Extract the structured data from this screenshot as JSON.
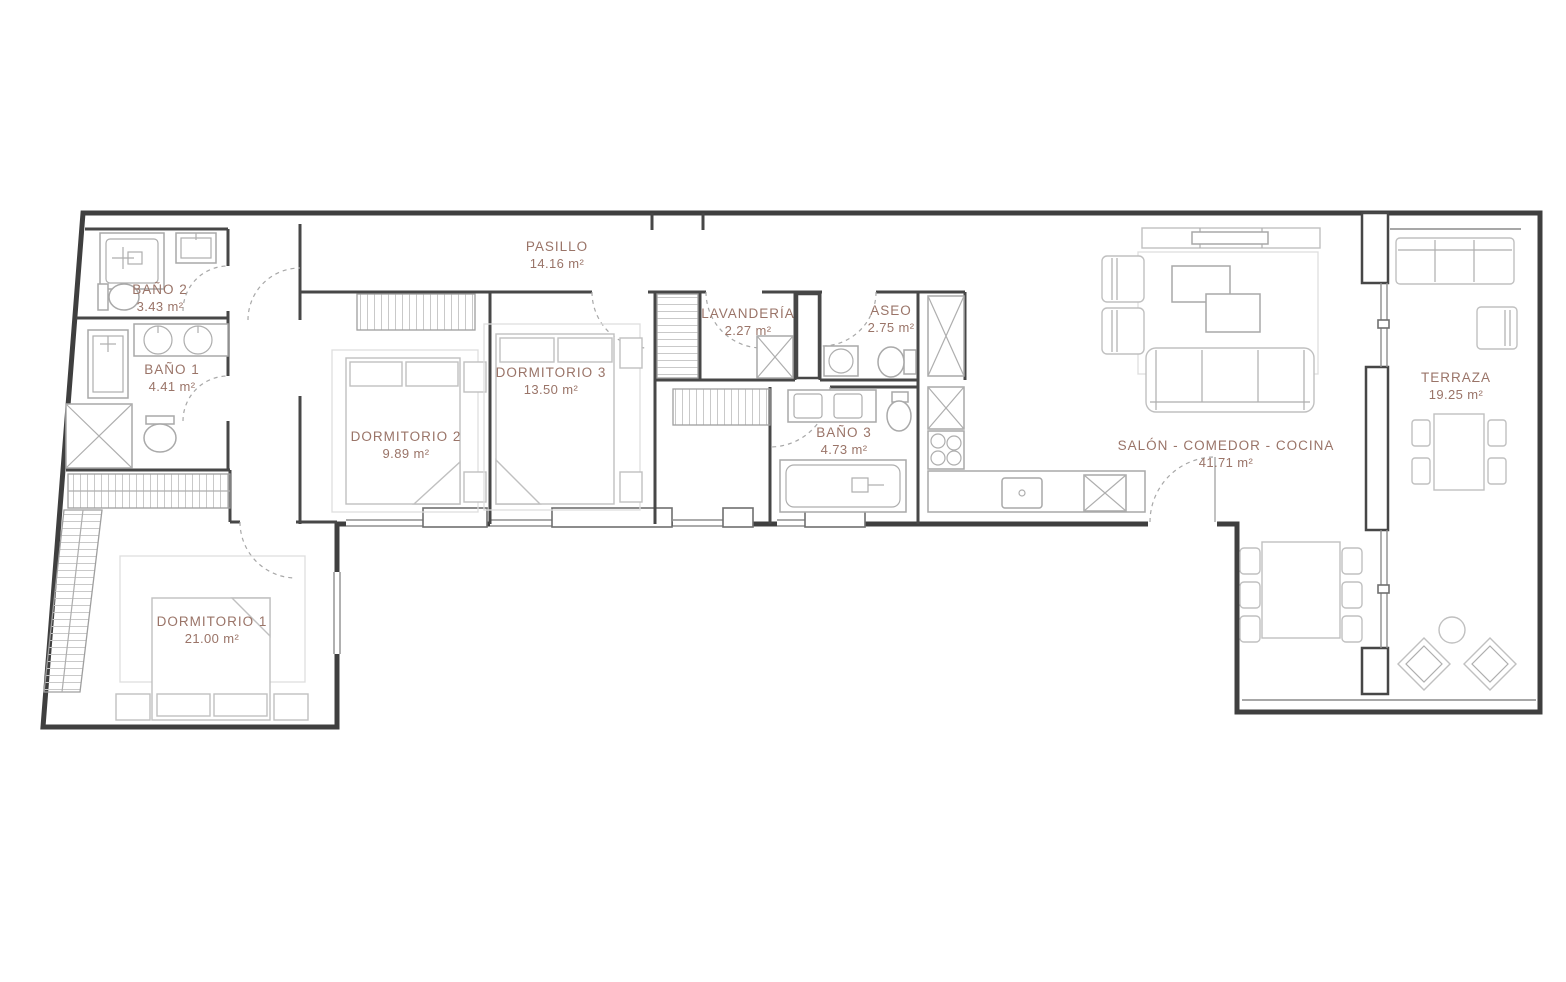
{
  "plan_title": "Floor plan",
  "colors": {
    "label": "#9a7468",
    "wall": "#3f3f3f",
    "furniture": "#c0c0c0"
  },
  "rooms": [
    {
      "id": "bano2",
      "name": "BAÑO 2",
      "area": "3.43 m²"
    },
    {
      "id": "bano1",
      "name": "BAÑO 1",
      "area": "4.41 m²"
    },
    {
      "id": "pasillo",
      "name": "PASILLO",
      "area": "14.16 m²"
    },
    {
      "id": "dormitorio2",
      "name": "DORMITORIO 2",
      "area": "9.89 m²"
    },
    {
      "id": "dormitorio3",
      "name": "DORMITORIO 3",
      "area": "13.50 m²"
    },
    {
      "id": "lavanderia",
      "name": "LAVANDERÍA",
      "area": "2.27 m²"
    },
    {
      "id": "aseo",
      "name": "ASEO",
      "area": "2.75 m²"
    },
    {
      "id": "bano3",
      "name": "BAÑO 3",
      "area": "4.73 m²"
    },
    {
      "id": "salon",
      "name": "SALÓN - COMEDOR - COCINA",
      "area": "41.71 m²"
    },
    {
      "id": "terraza",
      "name": "TERRAZA",
      "area": "19.25 m²"
    },
    {
      "id": "dormitorio1",
      "name": "DORMITORIO 1",
      "area": "21.00 m²"
    }
  ]
}
